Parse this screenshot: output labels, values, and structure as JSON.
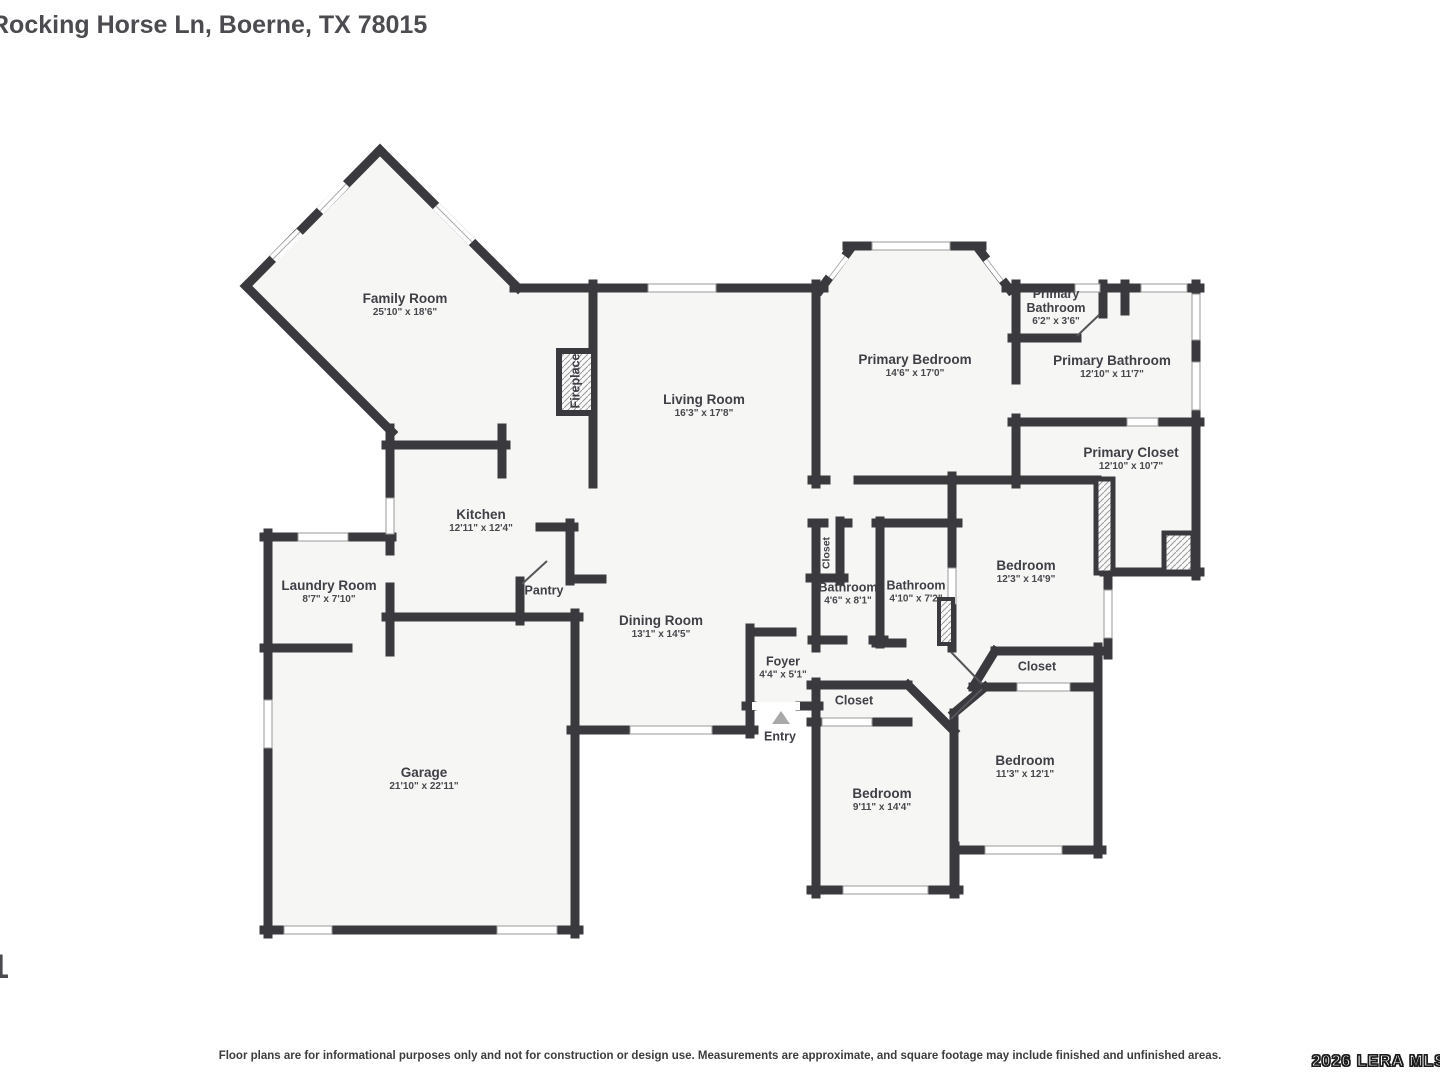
{
  "page": {
    "title": "Rocking Horse Ln, Boerne, TX 78015",
    "page_number": "1",
    "disclaimer": "Floor plans are for informational purposes only and not for construction or design use. Measurements are approximate, and square footage may include finished and unfinished areas.",
    "watermark": "2026 LERA MLS"
  },
  "colors": {
    "wall": "#3a3a3e",
    "floor": "#f6f6f5",
    "label": "#3f3f46",
    "window": "#ffffff",
    "entry_arrow": "#a9a9a9"
  },
  "rooms": {
    "family_room": {
      "name": "Family Room",
      "dims": "25'10\" x 18'6\""
    },
    "living_room": {
      "name": "Living Room",
      "dims": "16'3\" x 17'8\""
    },
    "primary_bedroom": {
      "name": "Primary Bedroom",
      "dims": "14'6\" x 17'0\""
    },
    "primary_bathroom_small": {
      "name": "Primary Bathroom",
      "dims": "6'2\" x 3'6\""
    },
    "primary_bathroom": {
      "name": "Primary Bathroom",
      "dims": "12'10\" x 11'7\""
    },
    "primary_closet": {
      "name": "Primary Closet",
      "dims": "12'10\" x 10'7\""
    },
    "kitchen": {
      "name": "Kitchen",
      "dims": "12'11\" x 12'4\""
    },
    "laundry_room": {
      "name": "Laundry Room",
      "dims": "8'7\" x 7'10\""
    },
    "pantry": {
      "name": "Pantry"
    },
    "dining_room": {
      "name": "Dining Room",
      "dims": "13'1\" x 14'5\""
    },
    "foyer": {
      "name": "Foyer",
      "dims": "4'4\" x 5'1\""
    },
    "entry": {
      "name": "Entry"
    },
    "garage": {
      "name": "Garage",
      "dims": "21'10\" x 22'11\""
    },
    "bathroom_hall": {
      "name": "Bathroom",
      "dims": "4'6\" x 8'1\""
    },
    "bathroom_hall2": {
      "name": "Bathroom",
      "dims": "4'10\" x 7'2\""
    },
    "bedroom_1": {
      "name": "Bedroom",
      "dims": "12'3\" x 14'9\""
    },
    "bedroom_2": {
      "name": "Bedroom",
      "dims": "11'3\" x 12'1\""
    },
    "bedroom_3": {
      "name": "Bedroom",
      "dims": "9'11\" x 14'4\""
    },
    "closet_hall": {
      "name": "Closet"
    },
    "closet_bed2": {
      "name": "Closet"
    },
    "closet_bed3": {
      "name": "Closet"
    },
    "fireplace": {
      "name": "Fireplace"
    }
  }
}
